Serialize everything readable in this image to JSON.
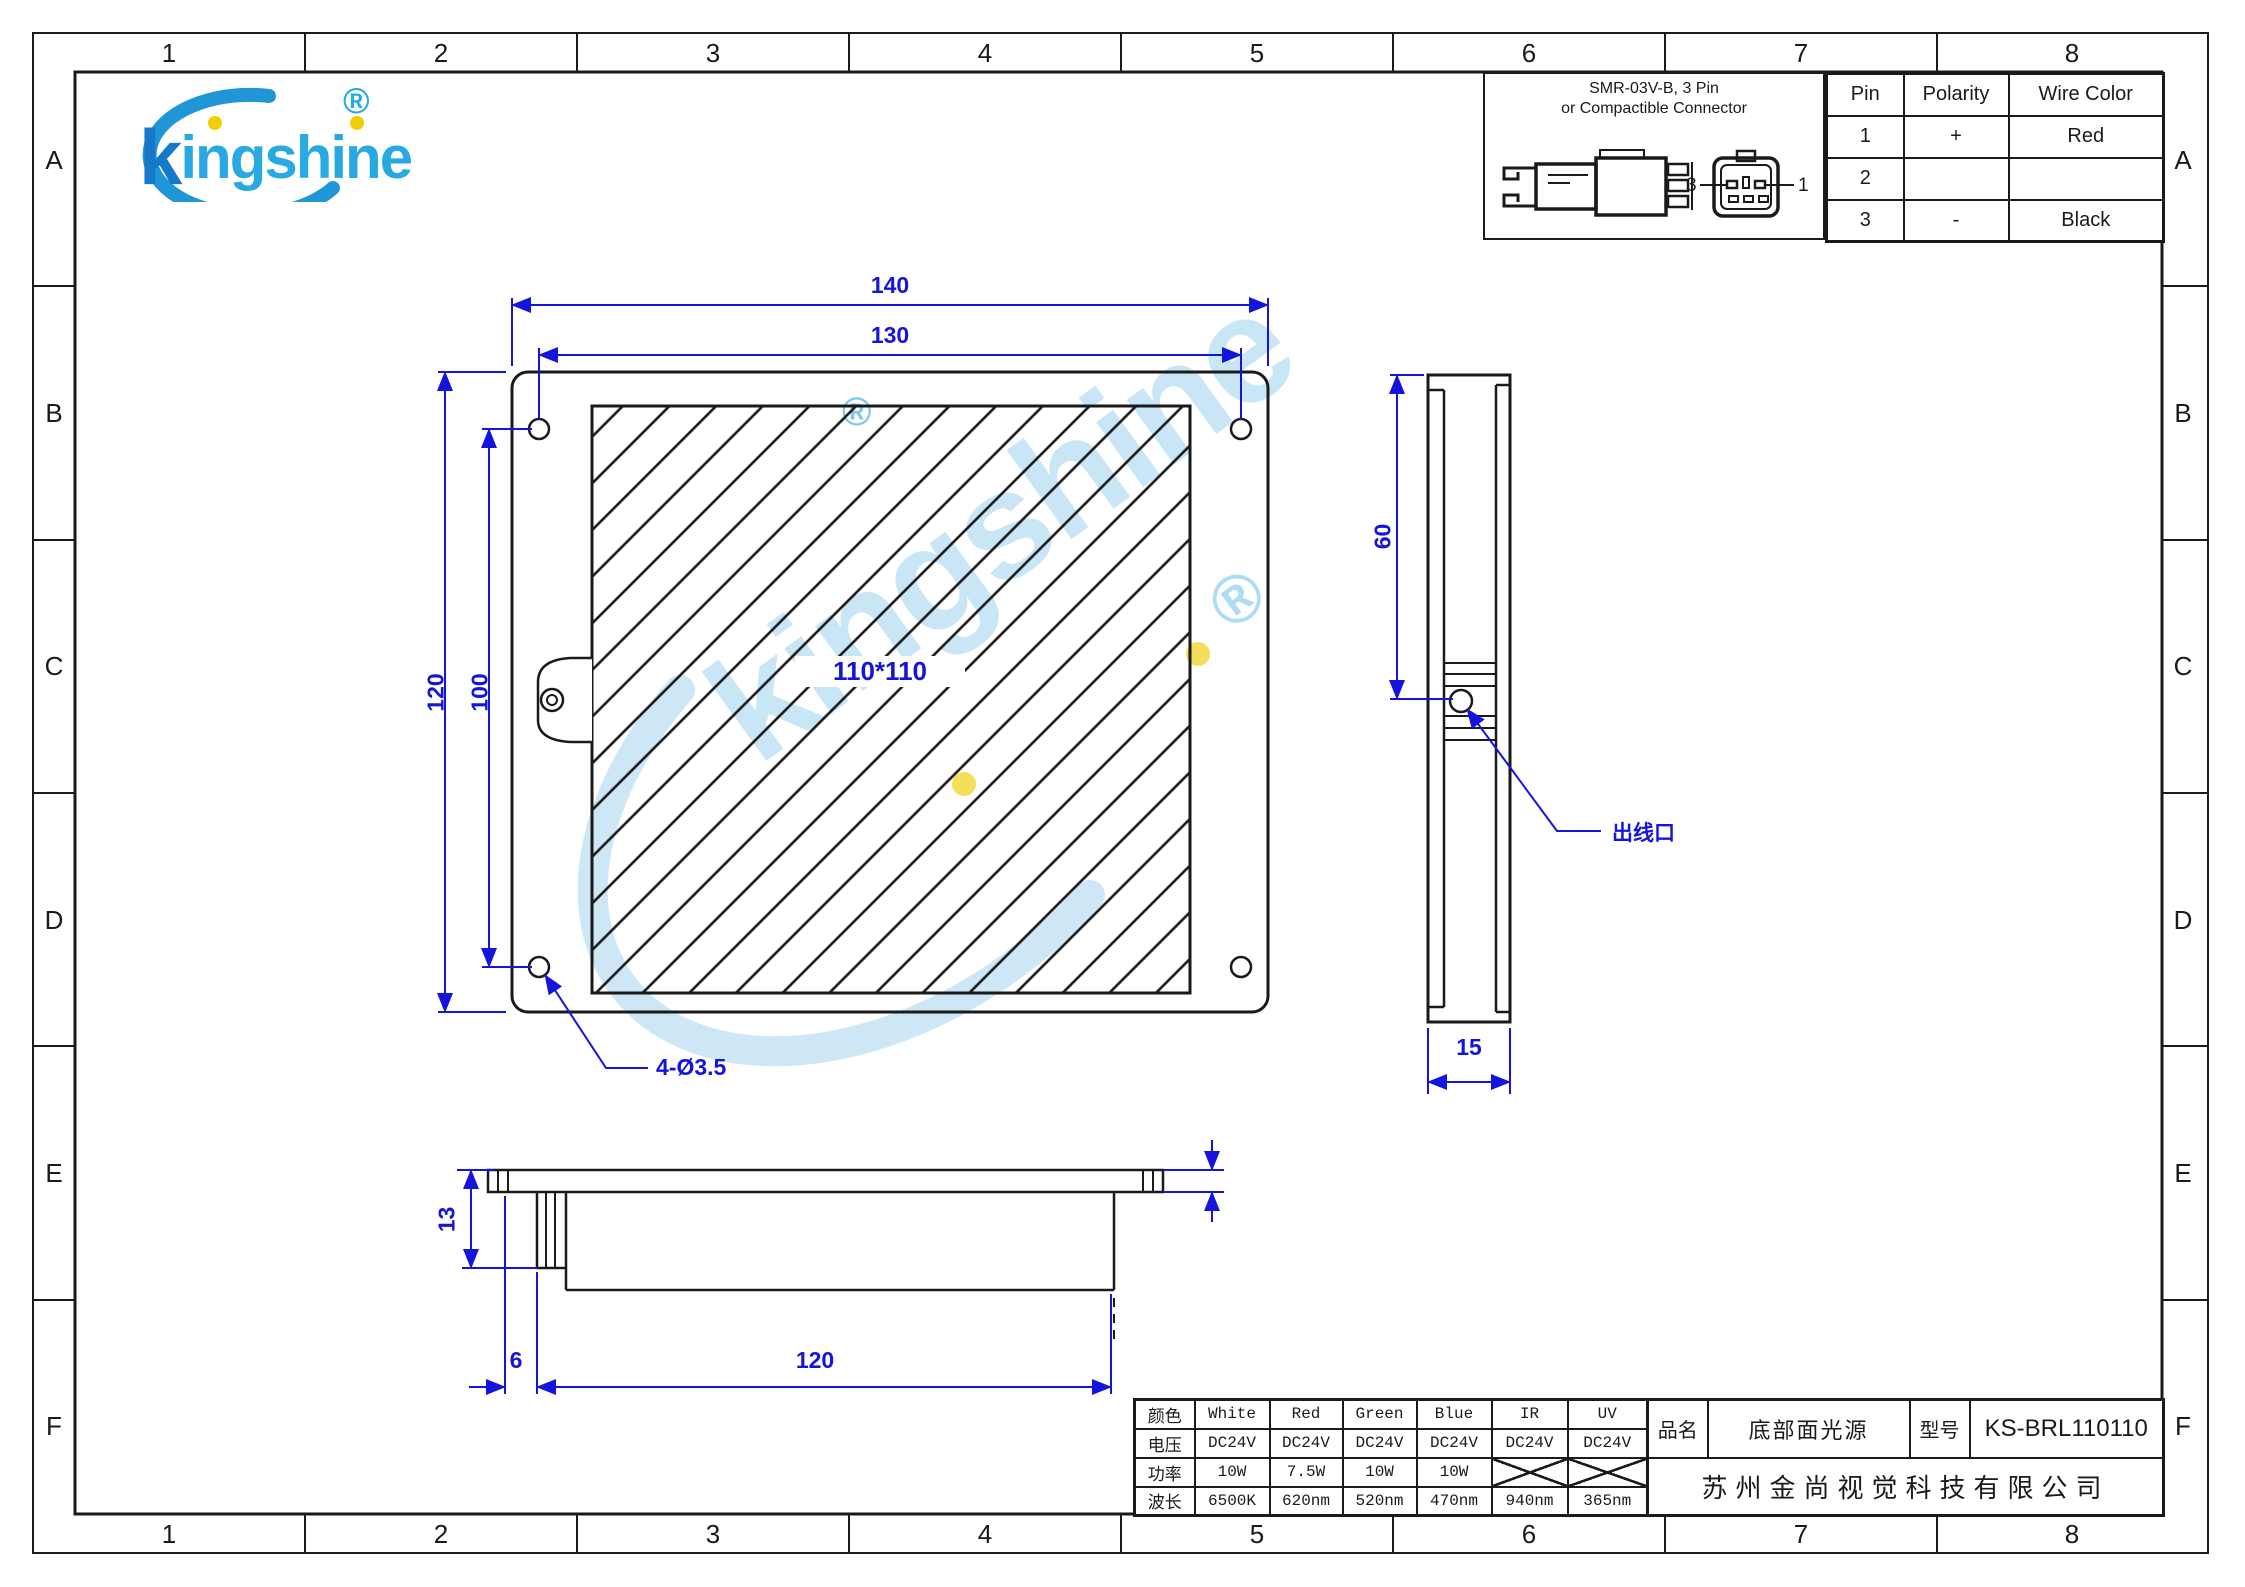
{
  "zones": {
    "columns": [
      "1",
      "2",
      "3",
      "4",
      "5",
      "6",
      "7",
      "8"
    ],
    "rows": [
      "A",
      "B",
      "C",
      "D",
      "E",
      "F"
    ]
  },
  "logo": {
    "text": "kingshine",
    "registered": "®"
  },
  "watermark": {
    "text": "kingshine",
    "registered": "®"
  },
  "connector": {
    "title_line1": "SMR-03V-B, 3 Pin",
    "title_line2": "or Compactible Connector",
    "label_left": "3",
    "label_right": "1",
    "headers": [
      "Pin",
      "Polarity",
      "Wire Color"
    ],
    "rows": [
      [
        "1",
        "+",
        "Red"
      ],
      [
        "2",
        "",
        ""
      ],
      [
        "3",
        "-",
        "Black"
      ]
    ]
  },
  "front_view": {
    "dim_width": "140",
    "dim_hole_h": "130",
    "dim_height": "120",
    "dim_hole_v": "100",
    "area": "110*110",
    "hole_callout": "4-Ø3.5"
  },
  "side_view": {
    "dim_top": "60",
    "dim_width": "15",
    "outlet": "出线口"
  },
  "bottom_view": {
    "dim_height": "13",
    "dim_step": "6",
    "dim_width": "120"
  },
  "spec": {
    "labels": [
      "颜色",
      "电压",
      "功率",
      "波长"
    ],
    "colors": [
      "White",
      "Red",
      "Green",
      "Blue",
      "IR",
      "UV"
    ],
    "voltage": [
      "DC24V",
      "DC24V",
      "DC24V",
      "DC24V",
      "DC24V",
      "DC24V"
    ],
    "power": [
      "10W",
      "7.5W",
      "10W",
      "10W",
      "",
      ""
    ],
    "wavelength": [
      "6500K",
      "620nm",
      "520nm",
      "470nm",
      "940nm",
      "365nm"
    ]
  },
  "title_block": {
    "name_label": "品名",
    "name": "底部面光源",
    "model_label": "型号",
    "model": "KS-BRL110110",
    "company": "苏州金尚视觉科技有限公司"
  }
}
